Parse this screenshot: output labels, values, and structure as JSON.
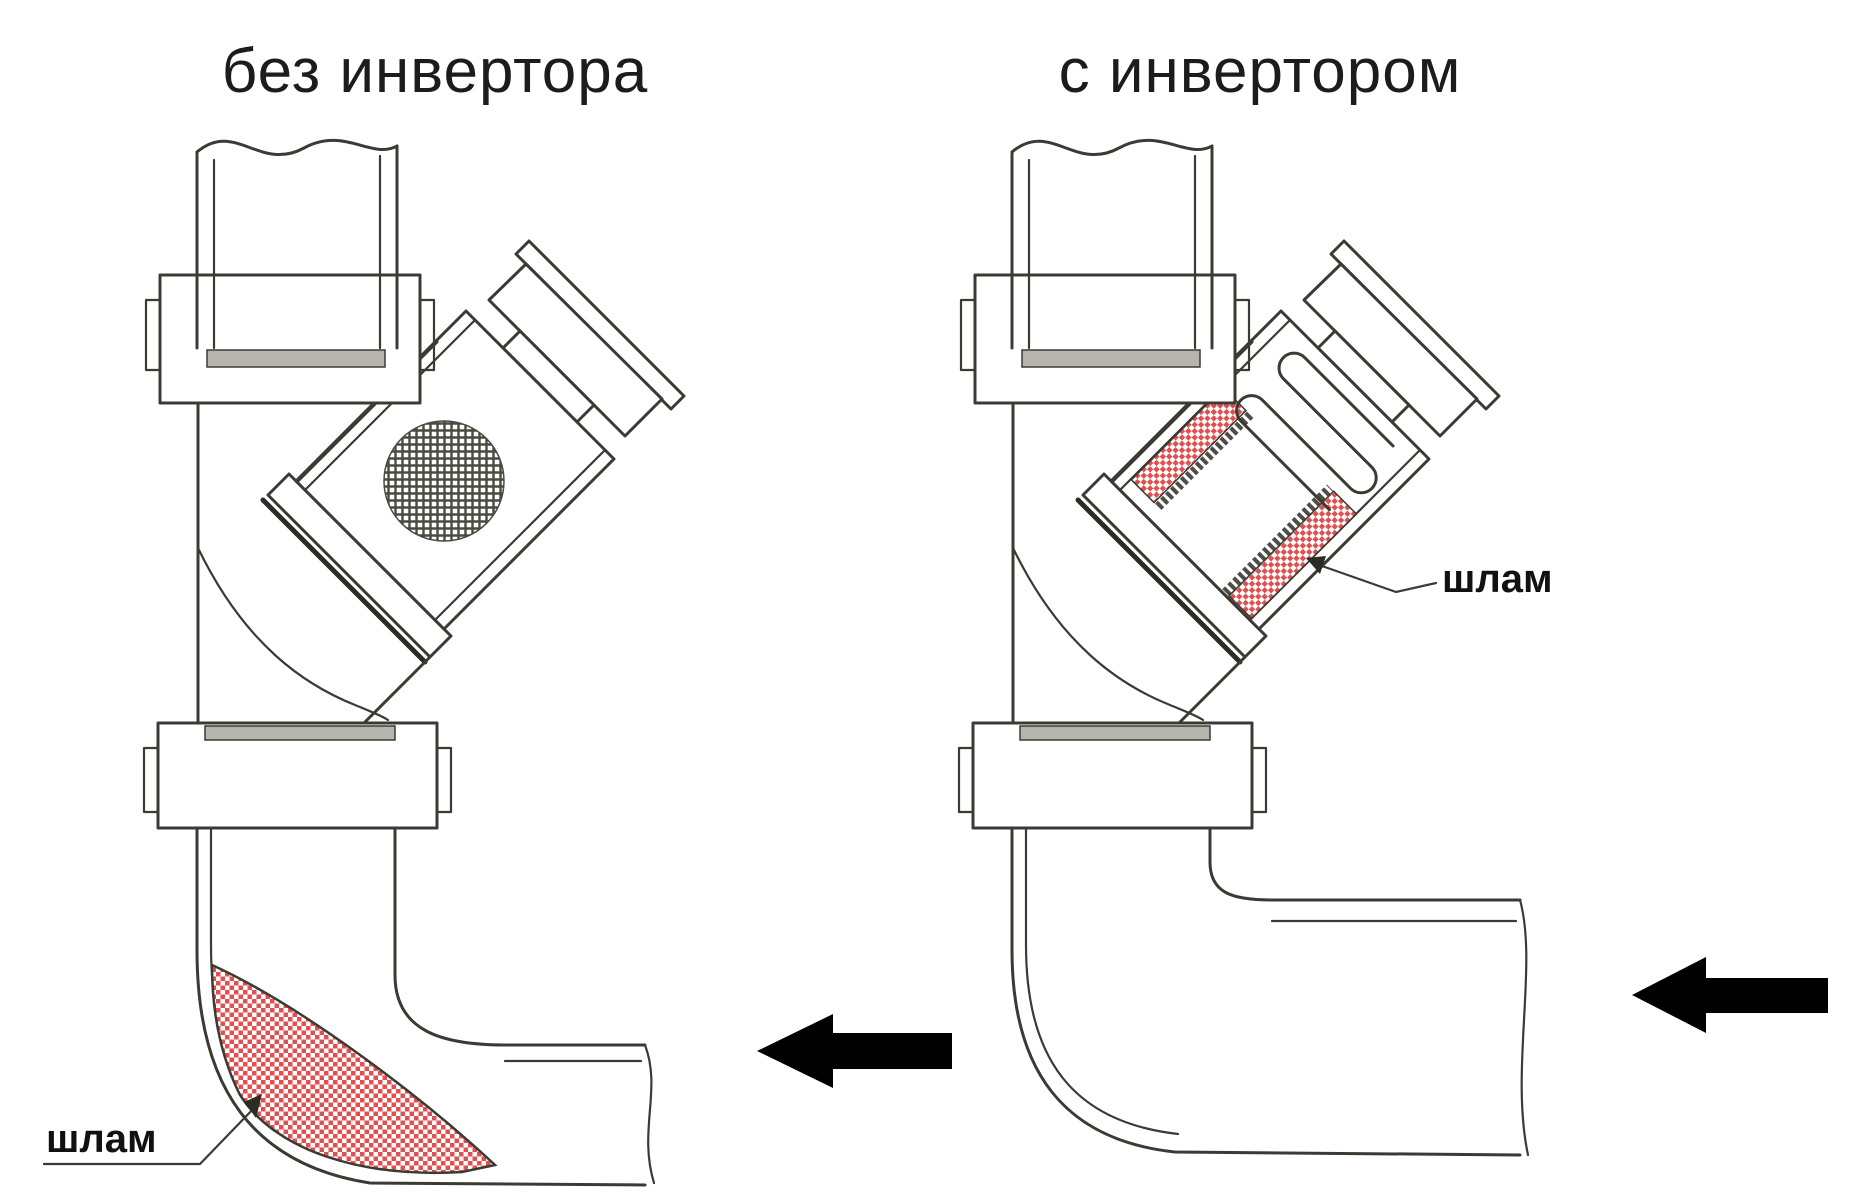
{
  "page": {
    "background": "#ffffff",
    "width": 1875,
    "height": 1196
  },
  "colors": {
    "line": "#3b3b33",
    "sludge_red": "#e05050",
    "mesh_dark": "#4a4a40",
    "seam_gray": "#b5b5ad",
    "arrow_black": "#000000",
    "title_color": "#1c1c1c"
  },
  "diagrams": [
    {
      "id": "without-inverter",
      "title": "без инвертора",
      "sludge_label": "шлам",
      "flow_direction": "left"
    },
    {
      "id": "with-inverter",
      "title": "с инвертором",
      "sludge_label": "шлам",
      "flow_direction": "left"
    }
  ]
}
